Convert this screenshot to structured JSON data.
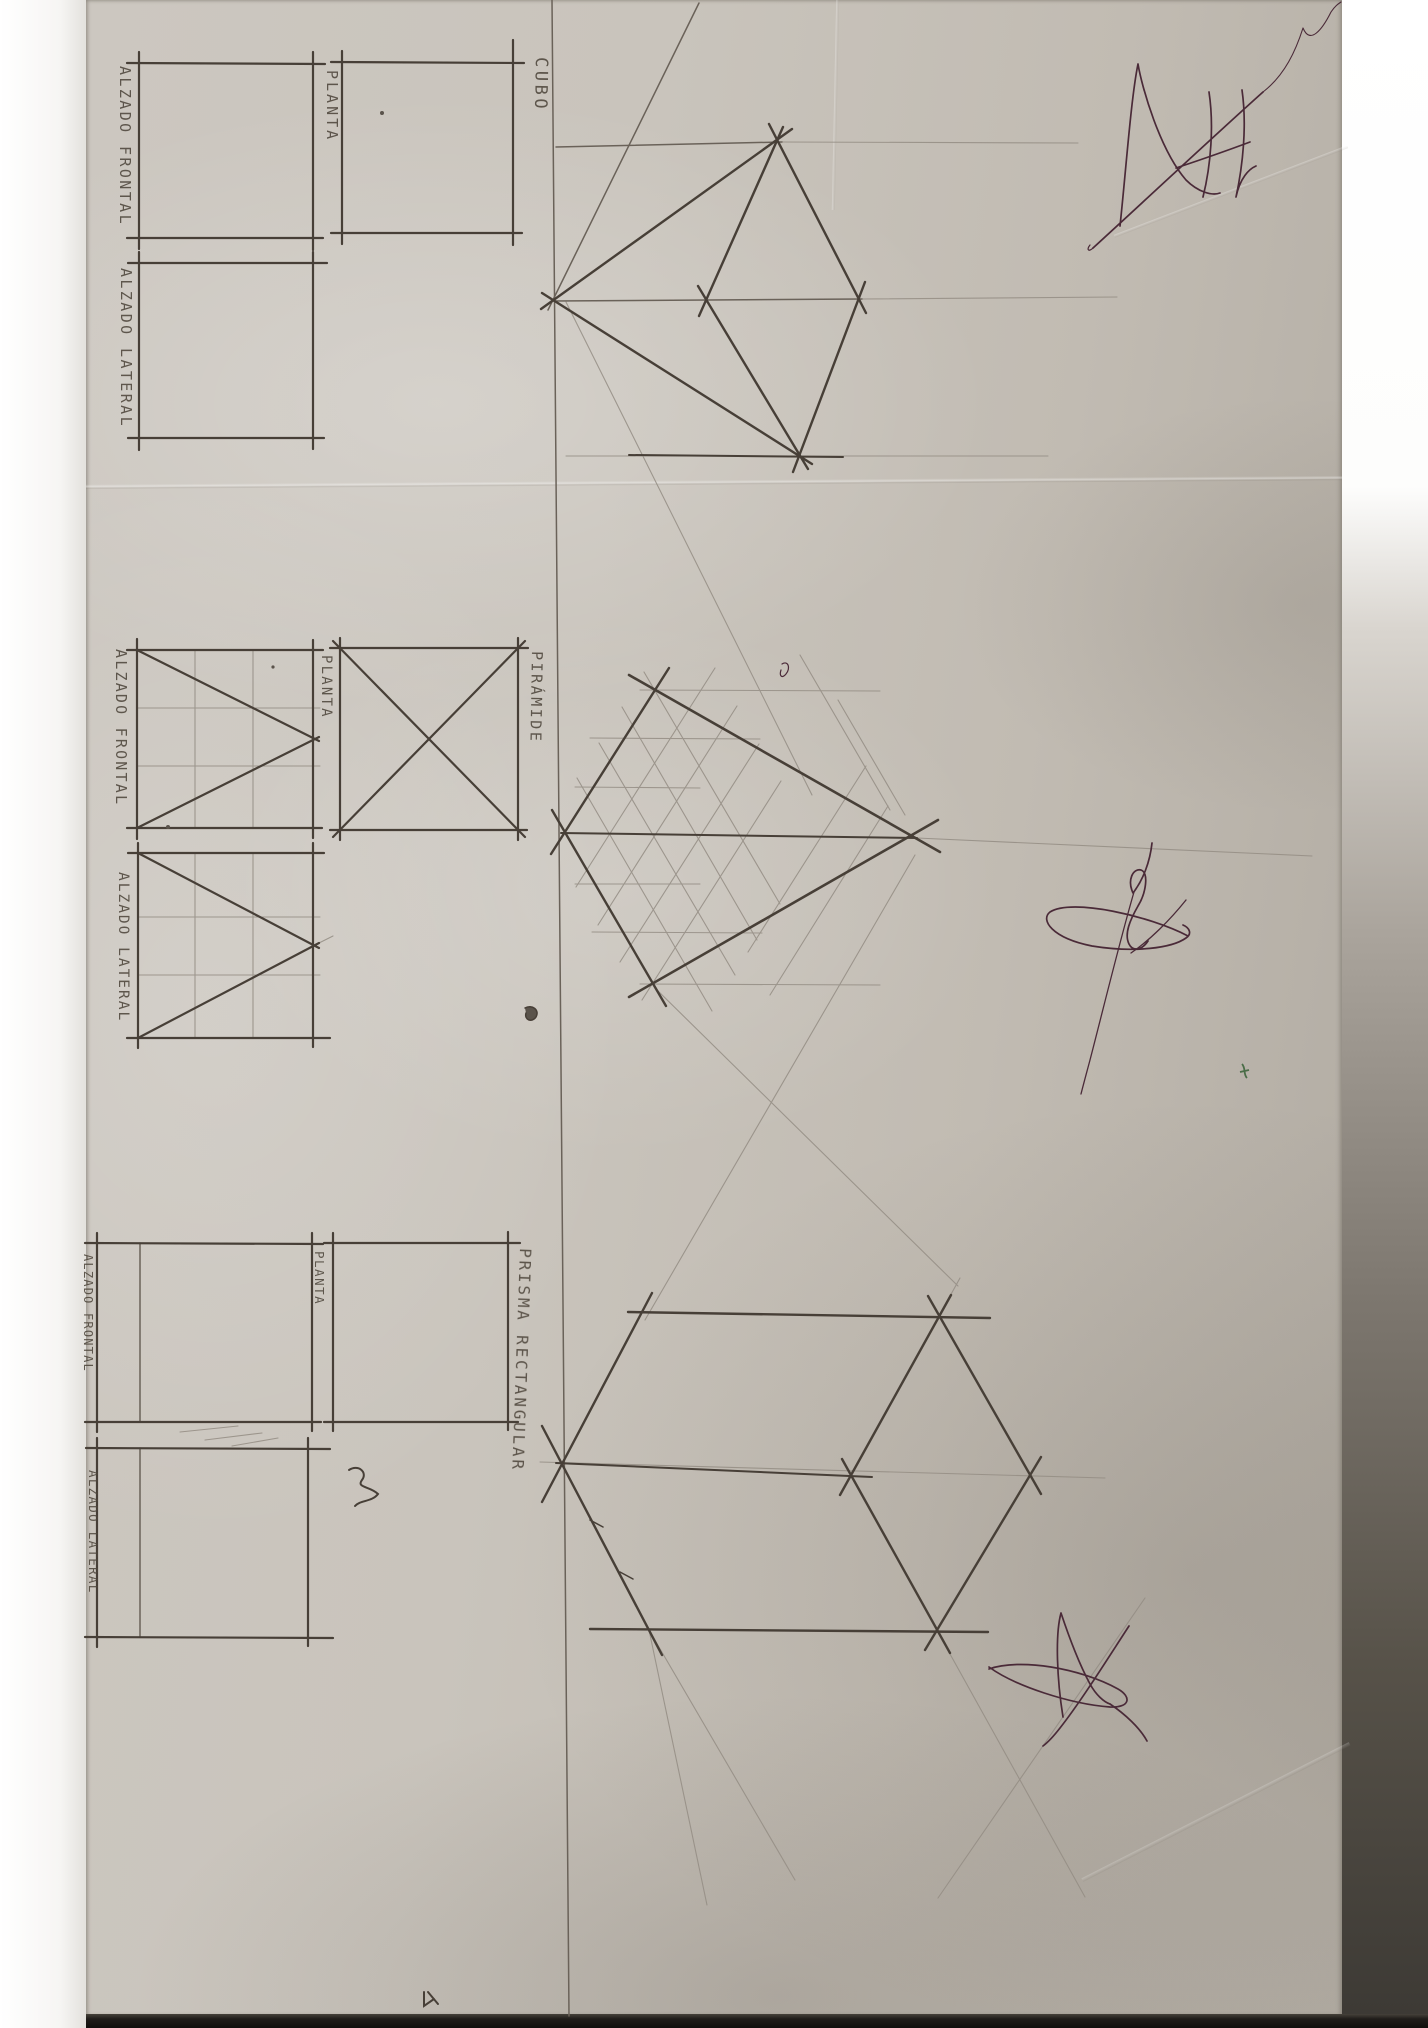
{
  "labels": {
    "cube": {
      "title": "CUBO",
      "frontal": "ALZADO FRONTAL",
      "lateral": "ALZADO LATERAL",
      "plan": "PLANTA"
    },
    "pyramid": {
      "title": "PIRÁMIDE",
      "frontal": "ALZADO FRONTAL",
      "lateral": "ALZADO LATERAL",
      "plan": "PLANTA"
    },
    "prism": {
      "title": "PRISMA RECTANGULAR",
      "frontal": "ALZADO FRONTAL",
      "lateral": "ALZADO LATERAL",
      "plan": "PLANTA"
    }
  },
  "colors": {
    "background": "#fbfbfa",
    "paper": "#c6c1b9",
    "pencil_dark": "#473f37",
    "pencil_medium": "#6a6259",
    "pencil_faint": "#948d84",
    "pencil_text": "#4e463c",
    "pen": "#4a2a38",
    "table_shadow": "#12100e",
    "green_speck": "#4a6d48"
  }
}
